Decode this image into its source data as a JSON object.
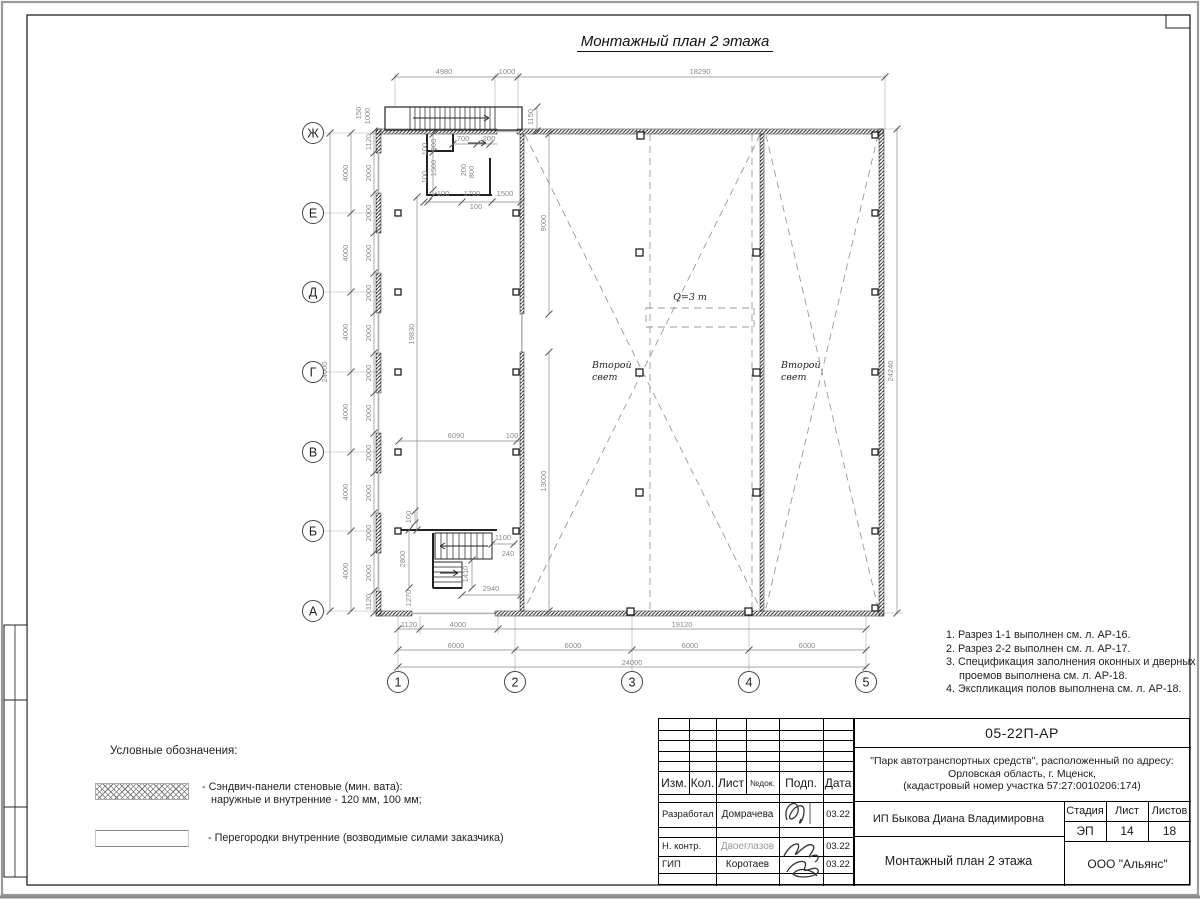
{
  "drawing_title": "Монтажный план 2 этажа",
  "plan": {
    "row_axes": [
      {
        "label": "Ж",
        "y": 133
      },
      {
        "label": "Е",
        "y": 213
      },
      {
        "label": "Д",
        "y": 292
      },
      {
        "label": "Г",
        "y": 372
      },
      {
        "label": "В",
        "y": 452
      },
      {
        "label": "Б",
        "y": 531
      },
      {
        "label": "А",
        "y": 611
      }
    ],
    "col_axes": [
      {
        "label": "1",
        "x": 398
      },
      {
        "label": "2",
        "x": 515
      },
      {
        "label": "3",
        "x": 632
      },
      {
        "label": "4",
        "x": 749
      },
      {
        "label": "5",
        "x": 866
      }
    ],
    "text_labels": [
      {
        "t": "Q=3 т",
        "x": 690,
        "y": 300,
        "anchor": "middle"
      },
      {
        "t": "Второй",
        "x": 592,
        "y": 368,
        "anchor": "start"
      },
      {
        "t": "свет",
        "x": 592,
        "y": 380,
        "anchor": "start"
      },
      {
        "t": "Второй",
        "x": 781,
        "y": 368,
        "anchor": "start"
      },
      {
        "t": "свет",
        "x": 781,
        "y": 380,
        "anchor": "start"
      }
    ],
    "dim_labels": [
      {
        "t": "4980",
        "x": 444,
        "y": 74
      },
      {
        "t": "1000",
        "x": 507,
        "y": 74
      },
      {
        "t": "18290",
        "x": 700,
        "y": 74
      },
      {
        "t": "1150",
        "x": 533,
        "y": 117,
        "r": -90
      },
      {
        "t": "150",
        "x": 361,
        "y": 113,
        "r": -90
      },
      {
        "t": "1000",
        "x": 370,
        "y": 116,
        "r": -90
      },
      {
        "t": "24000",
        "x": 327,
        "y": 372,
        "r": -90
      },
      {
        "t": "4000",
        "x": 348,
        "y": 173,
        "r": -90
      },
      {
        "t": "4000",
        "x": 348,
        "y": 253,
        "r": -90
      },
      {
        "t": "4000",
        "x": 348,
        "y": 332,
        "r": -90
      },
      {
        "t": "4000",
        "x": 348,
        "y": 412,
        "r": -90
      },
      {
        "t": "4000",
        "x": 348,
        "y": 492,
        "r": -90
      },
      {
        "t": "4000",
        "x": 348,
        "y": 571,
        "r": -90
      },
      {
        "t": "1120",
        "x": 371,
        "y": 142,
        "r": -90
      },
      {
        "t": "2000",
        "x": 371,
        "y": 173,
        "r": -90
      },
      {
        "t": "2000",
        "x": 371,
        "y": 213,
        "r": -90
      },
      {
        "t": "2000",
        "x": 371,
        "y": 253,
        "r": -90
      },
      {
        "t": "2000",
        "x": 371,
        "y": 293,
        "r": -90
      },
      {
        "t": "2000",
        "x": 371,
        "y": 333,
        "r": -90
      },
      {
        "t": "2000",
        "x": 371,
        "y": 373,
        "r": -90
      },
      {
        "t": "2000",
        "x": 371,
        "y": 413,
        "r": -90
      },
      {
        "t": "2000",
        "x": 371,
        "y": 453,
        "r": -90
      },
      {
        "t": "2000",
        "x": 371,
        "y": 493,
        "r": -90
      },
      {
        "t": "2000",
        "x": 371,
        "y": 533,
        "r": -90
      },
      {
        "t": "2000",
        "x": 371,
        "y": 573,
        "r": -90
      },
      {
        "t": "1120",
        "x": 371,
        "y": 602,
        "r": -90
      },
      {
        "t": "24240",
        "x": 893,
        "y": 371,
        "r": -90
      },
      {
        "t": "100",
        "x": 427,
        "y": 149,
        "r": -90
      },
      {
        "t": "900",
        "x": 436,
        "y": 145,
        "r": -90
      },
      {
        "t": "100",
        "x": 427,
        "y": 177,
        "r": -90
      },
      {
        "t": "1500",
        "x": 436,
        "y": 168,
        "r": -90
      },
      {
        "t": "700",
        "x": 463,
        "y": 141
      },
      {
        "t": "200",
        "x": 489,
        "y": 141
      },
      {
        "t": "200",
        "x": 466,
        "y": 170,
        "r": -90
      },
      {
        "t": "800",
        "x": 474,
        "y": 172,
        "r": -90
      },
      {
        "t": "100",
        "x": 443,
        "y": 196
      },
      {
        "t": "1700",
        "x": 472,
        "y": 196
      },
      {
        "t": "1500",
        "x": 505,
        "y": 196
      },
      {
        "t": "100",
        "x": 476,
        "y": 209
      },
      {
        "t": "19830",
        "x": 414,
        "y": 334,
        "r": -90
      },
      {
        "t": "9000",
        "x": 546,
        "y": 223,
        "r": -90
      },
      {
        "t": "6090",
        "x": 456,
        "y": 438
      },
      {
        "t": "100",
        "x": 512,
        "y": 438
      },
      {
        "t": "13000",
        "x": 546,
        "y": 481,
        "r": -90
      },
      {
        "t": "100",
        "x": 411,
        "y": 517,
        "r": -90
      },
      {
        "t": "2800",
        "x": 405,
        "y": 559,
        "r": -90
      },
      {
        "t": "1270",
        "x": 411,
        "y": 598,
        "r": -90
      },
      {
        "t": "1100",
        "x": 503,
        "y": 540
      },
      {
        "t": "240",
        "x": 508,
        "y": 556
      },
      {
        "t": "1410",
        "x": 468,
        "y": 574,
        "r": -90
      },
      {
        "t": "2940",
        "x": 491,
        "y": 591
      },
      {
        "t": "1120",
        "x": 409,
        "y": 627
      },
      {
        "t": "4000",
        "x": 458,
        "y": 627
      },
      {
        "t": "19120",
        "x": 682,
        "y": 627
      },
      {
        "t": "6000",
        "x": 456,
        "y": 648
      },
      {
        "t": "6000",
        "x": 573,
        "y": 648
      },
      {
        "t": "6000",
        "x": 690,
        "y": 648
      },
      {
        "t": "6000",
        "x": 807,
        "y": 648
      },
      {
        "t": "24000",
        "x": 632,
        "y": 665
      }
    ]
  },
  "notes": [
    "1. Разрез 1-1 выполнен см. л. АР-16.",
    "2. Разрез 2-2 выполнен см. л. АР-17.",
    "3. Спецификация заполнения оконных и дверных проемов выполнена см. л. АР-18.",
    "4. Экспликация полов выполнена см. л. АР-18."
  ],
  "legend": {
    "heading": "Условные обозначения:",
    "items": [
      {
        "line1": "- Сэндвич-панели стеновые (мин. вата):",
        "line2": "наружные и внутренние - 120 мм, 100 мм;"
      },
      {
        "line1": "- Перегородки внутренние (возводимые силами заказчика)",
        "line2": ""
      }
    ]
  },
  "titleblock": {
    "doc_number": "05-22П-АР",
    "project_line1": "\"Парк автотранспортных средств\",  расположенный по адресу:",
    "project_line2": "Орловская область, г. Мценск,",
    "project_line3": "(кадастровый номер участка 57:27:0010206:174)",
    "header_cols": [
      "Изм.",
      "Кол.",
      "Лист",
      "№док.",
      "Подп.",
      "Дата"
    ],
    "rows": [
      {
        "role": "Разработал",
        "name": "Домрачева",
        "date": "03.22"
      },
      {
        "role": "Н. контр.",
        "name": "Двоеглазов",
        "date": "03.22"
      },
      {
        "role": "ГИП",
        "name": "Коротаев",
        "date": "03.22"
      }
    ],
    "client": "ИП Быкова Диана Владимировна",
    "stage_header": [
      "Стадия",
      "Лист",
      "Листов"
    ],
    "stage_values": [
      "ЭП",
      "14",
      "18"
    ],
    "sheet_title": "Монтажный план 2 этажа",
    "company": "ООО \"Альянс\""
  }
}
